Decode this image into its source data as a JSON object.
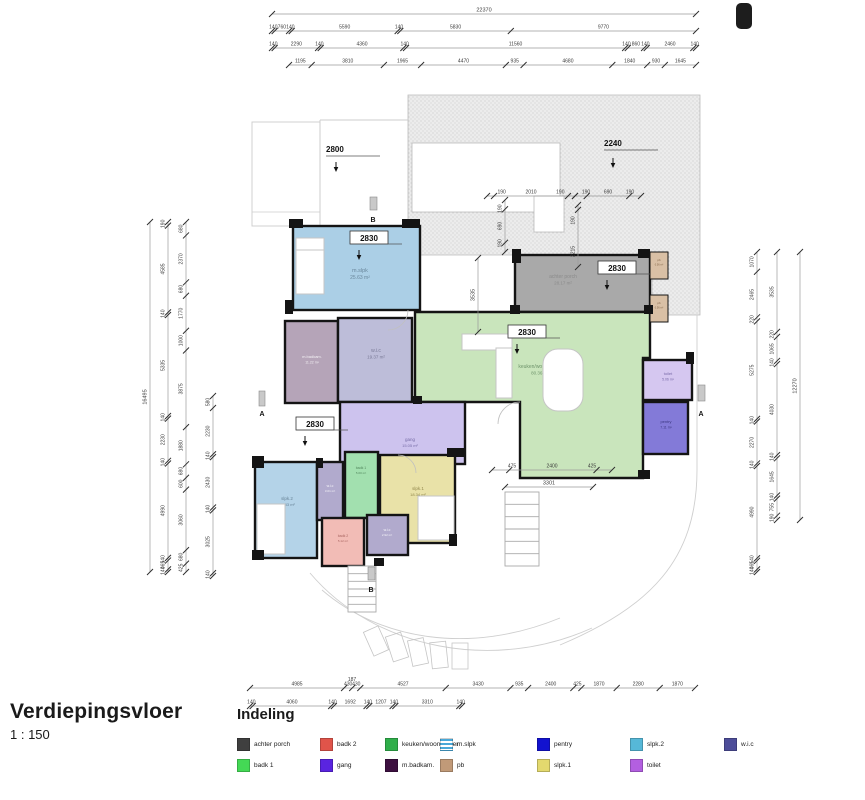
{
  "title": {
    "name": "Verdiepingsvloer",
    "scale": "1 : 150"
  },
  "legend": {
    "title": "Indeling",
    "items": [
      {
        "label": "achter porch",
        "color": "#3f3f3f",
        "swatch": "solid"
      },
      {
        "label": "badk 1",
        "color": "#44d955",
        "swatch": "solid"
      },
      {
        "label": "badk 2",
        "color": "#e0544a",
        "swatch": "solid"
      },
      {
        "label": "gang",
        "color": "#5a24e0",
        "swatch": "solid"
      },
      {
        "label": "keuken/woonkamer",
        "color": "#2fae4a",
        "swatch": "solid"
      },
      {
        "label": "m.badkam.",
        "color": "#3d1040",
        "swatch": "solid"
      },
      {
        "label": "m.slpk",
        "color": "#49a8d8",
        "swatch": "striped"
      },
      {
        "label": "pb",
        "color": "#c19a78",
        "swatch": "solid"
      },
      {
        "label": "pentry",
        "color": "#1212cf",
        "swatch": "solid"
      },
      {
        "label": "slpk.1",
        "color": "#e3d96e",
        "swatch": "solid"
      },
      {
        "label": "slpk.2",
        "color": "#56b8d8",
        "swatch": "solid"
      },
      {
        "label": "toilet",
        "color": "#b35fe0",
        "swatch": "solid"
      },
      {
        "label": "w.i.c",
        "color": "#4d4d99",
        "swatch": "solid"
      }
    ]
  },
  "rooms": {
    "achter_porch": {
      "label": "achter porch",
      "area": "28.17 m²",
      "color": "#a9a9a9"
    },
    "pb1": {
      "label": "pb",
      "area": "0.56 m²",
      "color": "#d9c0a5"
    },
    "pb2": {
      "label": "pb",
      "area": "0.56 m²",
      "color": "#d9c0a5"
    },
    "m_slpk": {
      "label": "m.slpk",
      "area": "25.63 m²",
      "color": "#abcfe6"
    },
    "m_badkam": {
      "label": "m.badkam.",
      "area": "11.22 m²",
      "color": "#b5a4b8"
    },
    "wic_main": {
      "label": "w.i.c",
      "area": "19.37 m²",
      "color": "#bdbdd9"
    },
    "keuken": {
      "label": "keuken/woonkamer",
      "area": "80.36 m²",
      "color": "#c9e5bc"
    },
    "toilet": {
      "label": "toilet",
      "area": "5.06 m²",
      "color": "#d5c7f0"
    },
    "pentry": {
      "label": "pentry",
      "area": "7.11 m²",
      "color": "#837ad8"
    },
    "gang": {
      "label": "gang",
      "area": "15.05 m²",
      "color": "#cdc3ee"
    },
    "slpk2": {
      "label": "slpk.2",
      "area": "18.33 m²",
      "color": "#b4d3e8"
    },
    "wic_1": {
      "label": "w.i.c",
      "area": "3.01 m²",
      "color": "#b1aacd"
    },
    "badk1": {
      "label": "badk 1",
      "area": "5.00 m²",
      "color": "#a2e0af"
    },
    "slpk1": {
      "label": "slpk.1",
      "area": "18.34 m²",
      "color": "#e9e2a8"
    },
    "badk2": {
      "label": "badk 2",
      "area": "5.12 m²",
      "color": "#f2bcb6"
    },
    "wic_2": {
      "label": "w.i.c",
      "area": "2.92 m²",
      "color": "#b1aacd"
    }
  },
  "dims": {
    "top": [
      [
        "22370"
      ],
      [
        "140",
        "760",
        "140",
        "5590",
        "140",
        "5830",
        "9770"
      ],
      [
        "140",
        "2290",
        "140",
        "4360",
        "140",
        "11560",
        "140",
        "860",
        "140",
        "2460",
        "140"
      ],
      [
        "1195",
        "3810",
        "1965",
        "4470",
        "935",
        "4680",
        "1840",
        "930",
        "1645"
      ]
    ],
    "left": [
      [
        "16495"
      ],
      [
        "190",
        "4585",
        "140",
        "5335",
        "140",
        "2230",
        "140",
        "4990",
        "140",
        "465",
        "140"
      ],
      [
        "680",
        "2370",
        "680",
        "1770",
        "1000",
        "3875",
        "1880",
        "680",
        "600",
        "3060",
        "680",
        "425"
      ],
      [
        "580",
        "2230",
        "140",
        "2430",
        "140",
        "3025",
        "140"
      ]
    ],
    "right": [
      [
        "1070",
        "2465",
        "220",
        "5275",
        "140",
        "2270",
        "140",
        "4990",
        "140",
        "465",
        "140"
      ],
      [
        "3535",
        "220",
        "1065",
        "140",
        "4030",
        "140",
        "1645",
        "140",
        "755",
        "190"
      ],
      [
        "12270"
      ]
    ],
    "bottom": [
      [
        "4985",
        "430",
        "430",
        "4527",
        "3430",
        "935",
        "2400",
        "425",
        "1870",
        "2280",
        "1870"
      ],
      [
        "140",
        "4060",
        "140",
        "1692",
        "140",
        "1207",
        "140",
        "3310",
        "140"
      ]
    ],
    "bottom_extra": "187",
    "inner_h": [
      [
        "190",
        "2010",
        "190"
      ],
      [
        "190",
        "690",
        "190"
      ],
      [
        "475",
        "2400",
        "425"
      ],
      [
        "3301"
      ]
    ],
    "inner_v": [
      [
        "190",
        "690",
        "190"
      ],
      [
        "190",
        "2215"
      ],
      [
        "3535"
      ]
    ],
    "heights": [
      "2800",
      "2240"
    ],
    "boxed_heights": [
      "2830",
      "2830",
      "2830",
      "2830"
    ]
  },
  "markers": {
    "section_a": "A",
    "section_b": "B"
  }
}
